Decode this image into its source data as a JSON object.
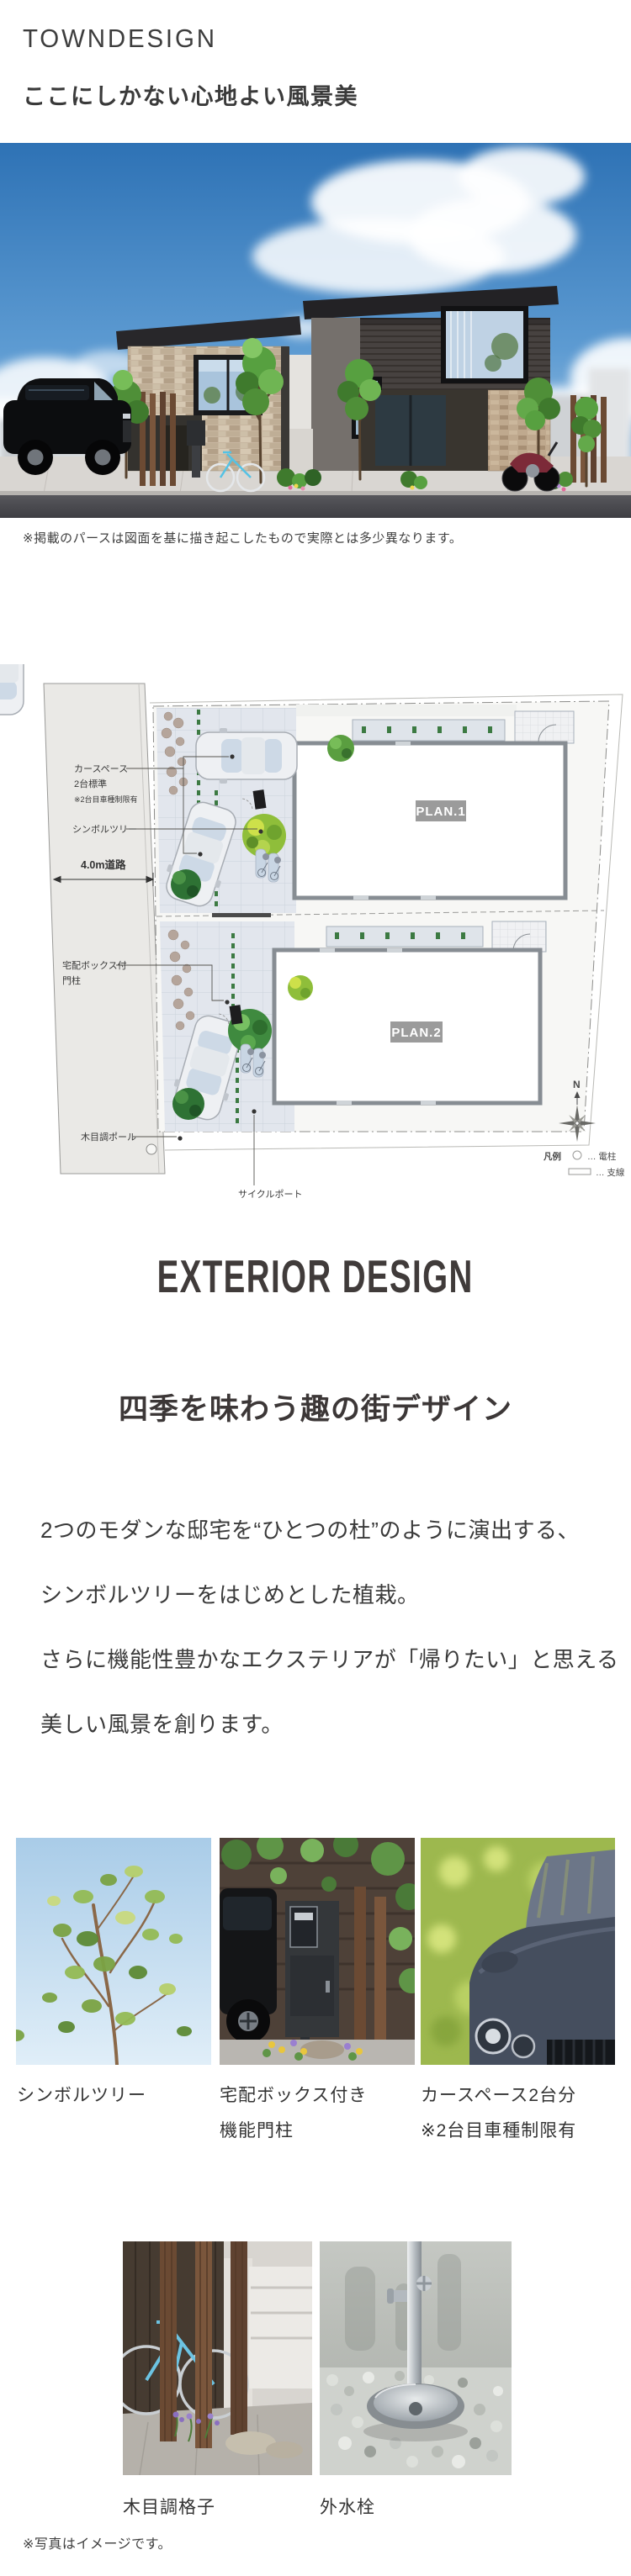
{
  "colors": {
    "text": "#3a3a3a",
    "badge_bg": "#9b9b9b",
    "badge_text": "#ffffff",
    "sky_accent": "#2e72b5",
    "tree_green": "#57a040"
  },
  "header": {
    "title": "TOWNDESIGN",
    "subtitle": "ここにしかない心地よい風景美"
  },
  "hero": {
    "note": "※掲載のパースは図面を基に描き起こしたもので実際とは多少異なります。"
  },
  "siteplan": {
    "plan1_label": "PLAN.1",
    "plan2_label": "PLAN.2",
    "carspace_line1": "カースペース",
    "carspace_line2": "2台標準",
    "carspace_note": "※2台目車種制限有",
    "symbol_tree": "シンボルツリー",
    "road": "4.0m道路",
    "delivery_line1": "宅配ボックス付",
    "delivery_line2": "門柱",
    "wood_pole": "木目調ポール",
    "cycle_port": "サイクルポート",
    "north": "N",
    "legend_title": "凡例",
    "legend_pole": "… 電柱",
    "legend_wire": "… 支線"
  },
  "exterior_section": {
    "heading_en": "EXTERIOR DESIGN",
    "heading_jp": "四季を味わう趣の街デザイン",
    "paragraph_lines": [
      "2つのモダンな邸宅を“ひとつの杜”のように演出する、",
      "シンボルツリーをはじめとした植栽。",
      "さらに機能性豊かなエクステリアが「帰りたい」と思える",
      "美しい風景を創ります。"
    ]
  },
  "gallery": {
    "row1": [
      {
        "caption_lines": [
          "シンボルツリー",
          ""
        ]
      },
      {
        "caption_lines": [
          "宅配ボックス付き",
          "機能門柱"
        ]
      },
      {
        "caption_lines": [
          "カースペース2台分",
          "※2台目車種制限有"
        ]
      }
    ],
    "row2": [
      {
        "caption_lines": [
          "木目調格子"
        ]
      },
      {
        "caption_lines": [
          "外水栓"
        ]
      }
    ],
    "note": "※写真はイメージです。"
  }
}
